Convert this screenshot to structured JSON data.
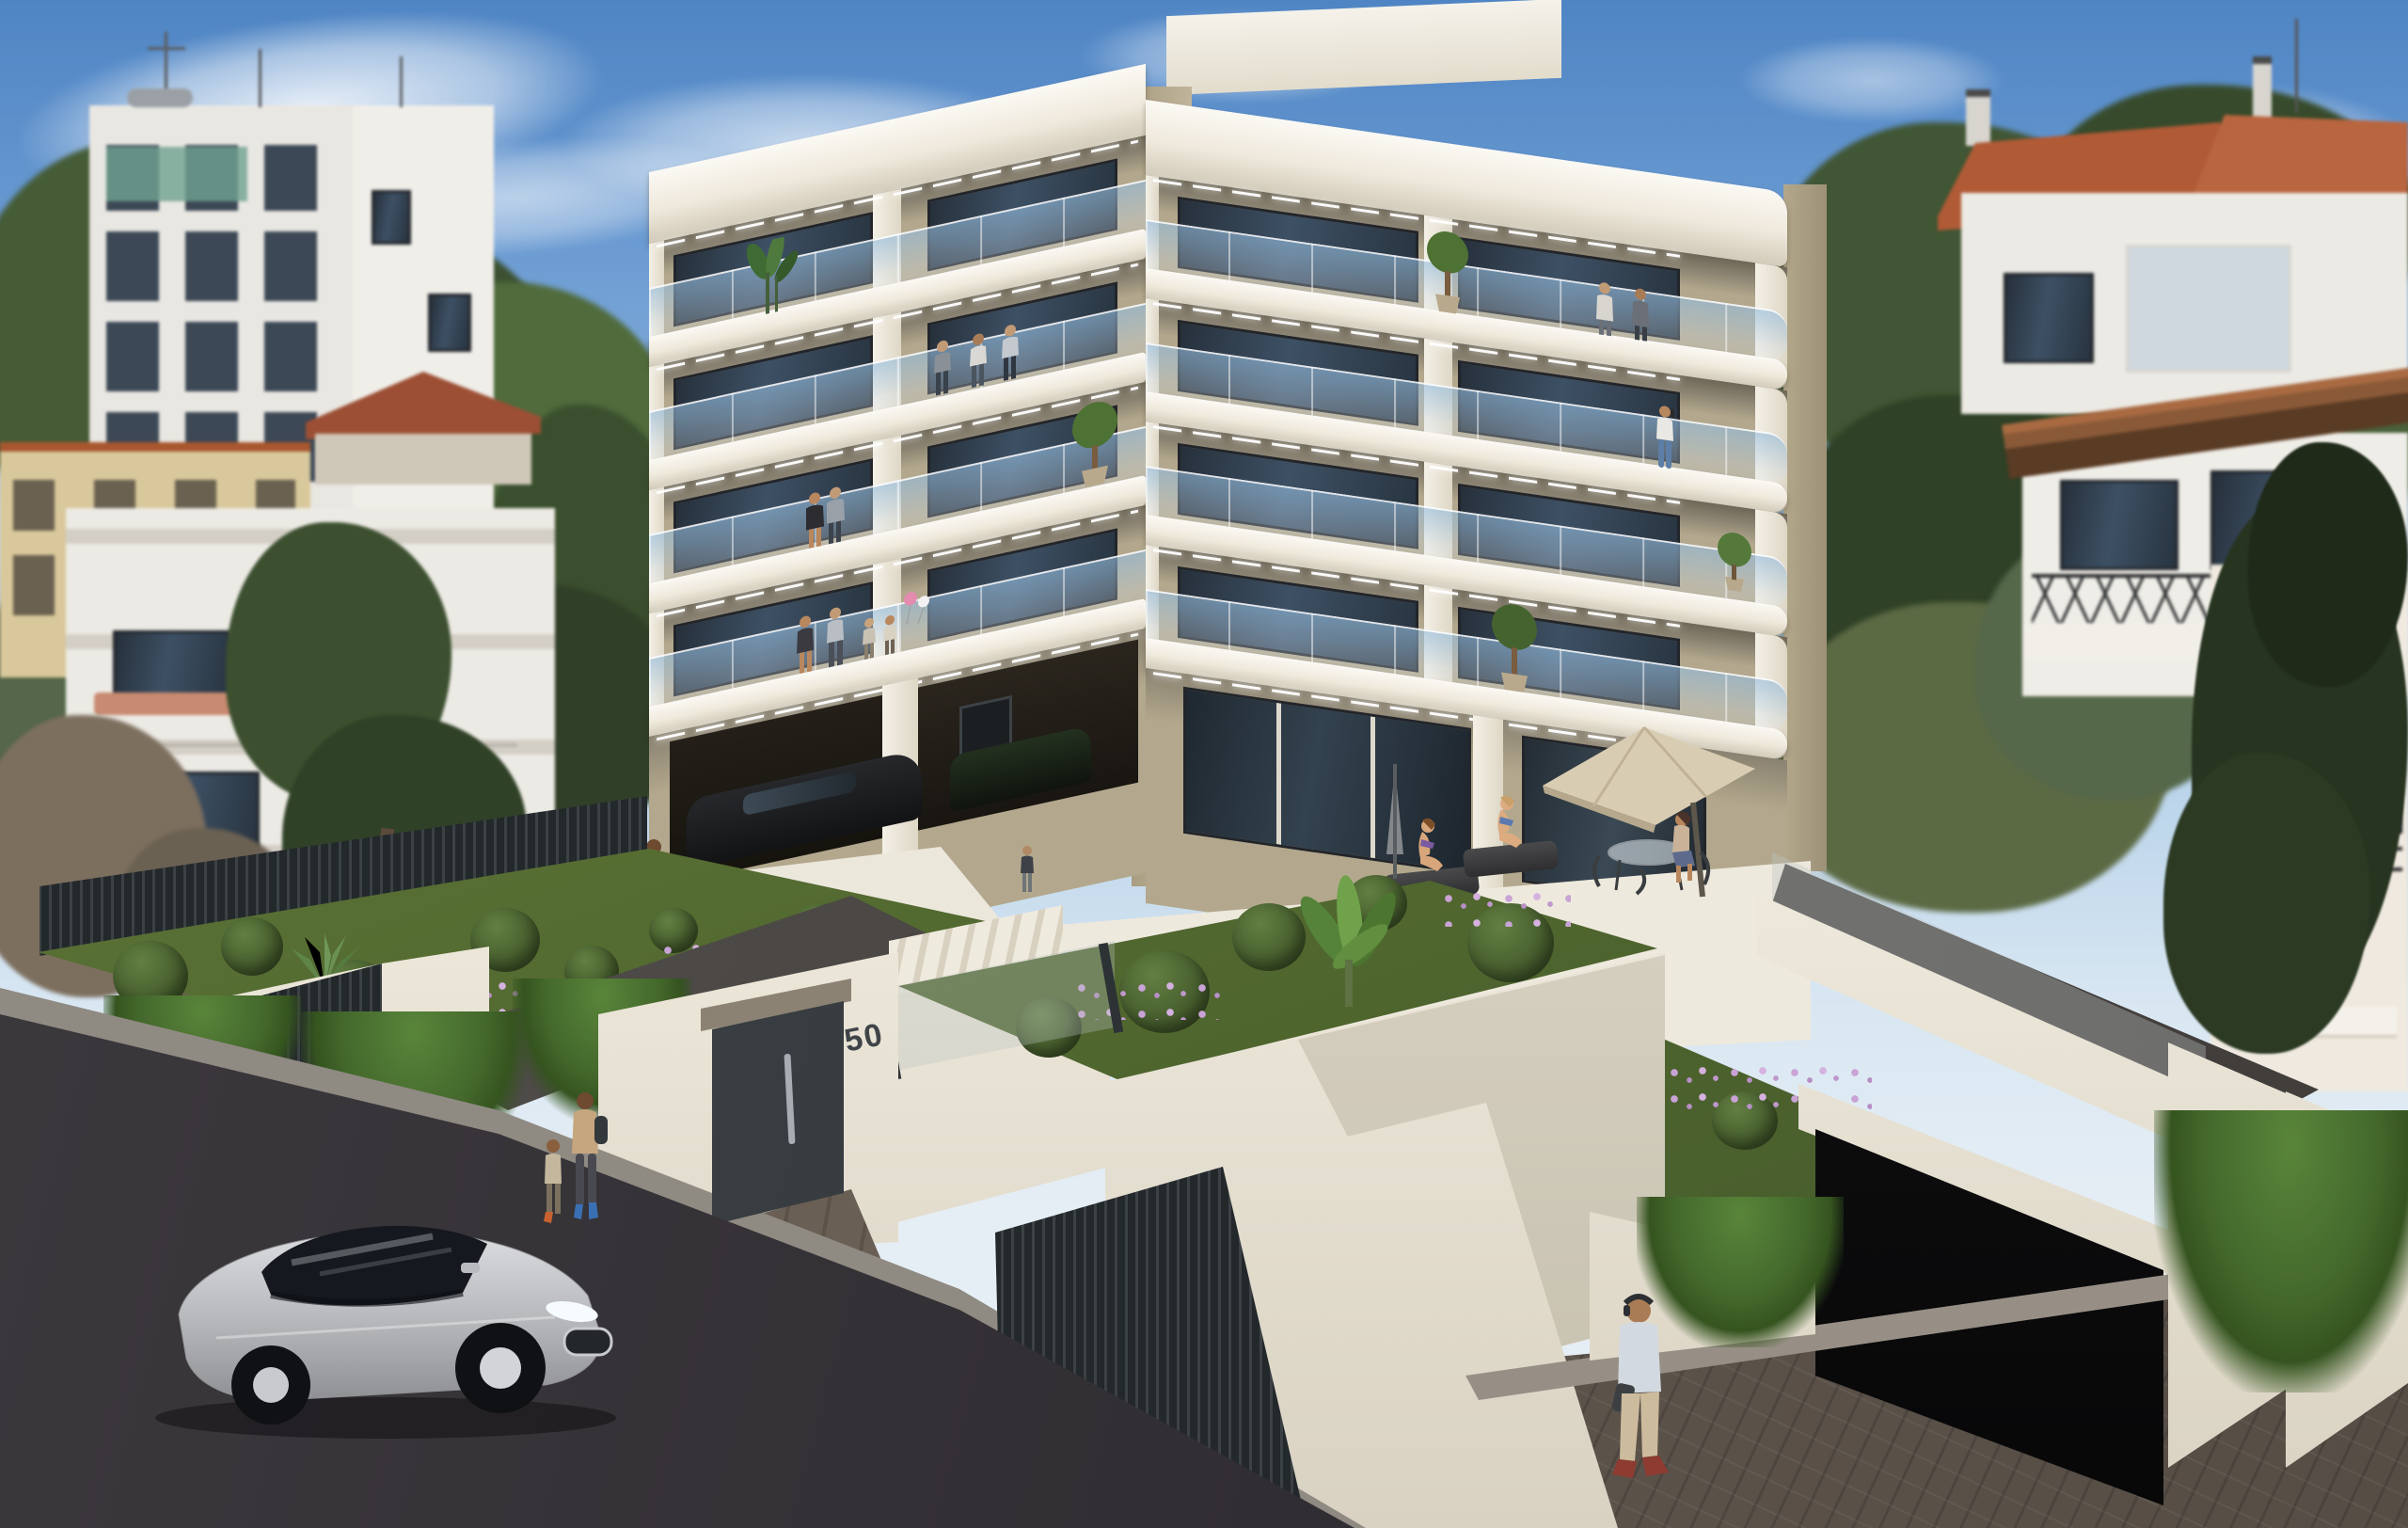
{
  "scene": {
    "type": "3D architectural exterior rendering",
    "setting": "Modern multi-storey apartment building on a sloping street in a hillside Mediterranean neighbourhood, sunny day",
    "house_number": "50"
  },
  "palette": {
    "sky_top": "#4f85c4",
    "sky_horizon": "#d9e7f2",
    "facade_white": "#f3f0e9",
    "facade_beige": "#b3a88d",
    "window_glass": "#3d5064",
    "railing_glass": "#a9cbe3",
    "greenery_dark": "#3a512c",
    "greenery_light": "#6f9c46",
    "flower_pink": "#c49ad0",
    "road_asphalt": "#333036",
    "paving_brown": "#5e544b",
    "fence_anthracite": "#2e3336",
    "wall_white": "#f6f3ec",
    "pool_water": "#bfe4ea",
    "roof_tile_orange": "#b85c38",
    "car_silver": "#c6c7cb",
    "umbrella_beige": "#cfc3a9",
    "sun_lounger_grey": "#3a3a3c"
  },
  "main_building": {
    "storeys_above_ground": 4,
    "wings": 2,
    "balconies": "wrap-around balconies with frameless glass railings, rounded outer corners and LED strip soffit lighting",
    "ground_floor": "beige rendered walls, full-height glazing, pilotis parking with dark parked cars, pool terrace",
    "balcony_people": [
      "three men talking on a 2nd floor balcony",
      "embracing couple on a 3rd floor balcony",
      "family with two children and balloons on the 1st floor balcony",
      "woman on the phone on the right wing balcony",
      "couple at the top floor railing of the right wing"
    ],
    "balcony_plants": [
      "strelitzia on the top-left balcony",
      "potted trees on several balconies"
    ]
  },
  "site": {
    "entrance": {
      "gate": "anthracite entrance gate with vertical pull handle",
      "number_plate": "50",
      "stairs": "outdoor stairs behind a glass balustrade"
    },
    "pools": [
      "main terrace pool with two women on sun loungers",
      "small plunge pool with a bather"
    ],
    "umbrellas": [
      "open beige parasol with outdoor table, chairs and a seated woman",
      "closed grey parasol"
    ],
    "gardens": [
      "terraced planters with clipped shrubs, grasses and pink flowers",
      "ivy cascading over white walls",
      "banana plant and agave"
    ],
    "walls_fences": [
      "white rendered retaining walls",
      "anthracite slatted fences and gates"
    ],
    "garage": "ramp descending to an underground garage on the right"
  },
  "street": {
    "vehicles": [
      "silver luxury sedan parked on the asphalt road"
    ],
    "pedestrians": [
      "woman with backpack walking with a child near the entrance",
      "man with headphones and tablet walking on the right sidewalk"
    ],
    "surfaces": [
      "dark asphalt road (bottom left)",
      "brown paved sidewalk (bottom right)"
    ]
  },
  "background": {
    "left": [
      "white apartment block with roof antennas and solar heaters",
      "ochre house",
      "white terraced house",
      "large pine tree",
      "dry tree"
    ],
    "right": [
      "houses with orange tiled roofs",
      "house with timber pergola roof and black cross railing",
      "white house with awnings",
      "tall dark cypress"
    ],
    "hillside": "dense green hillside vegetation",
    "sky": "blue sky with thin white clouds"
  }
}
